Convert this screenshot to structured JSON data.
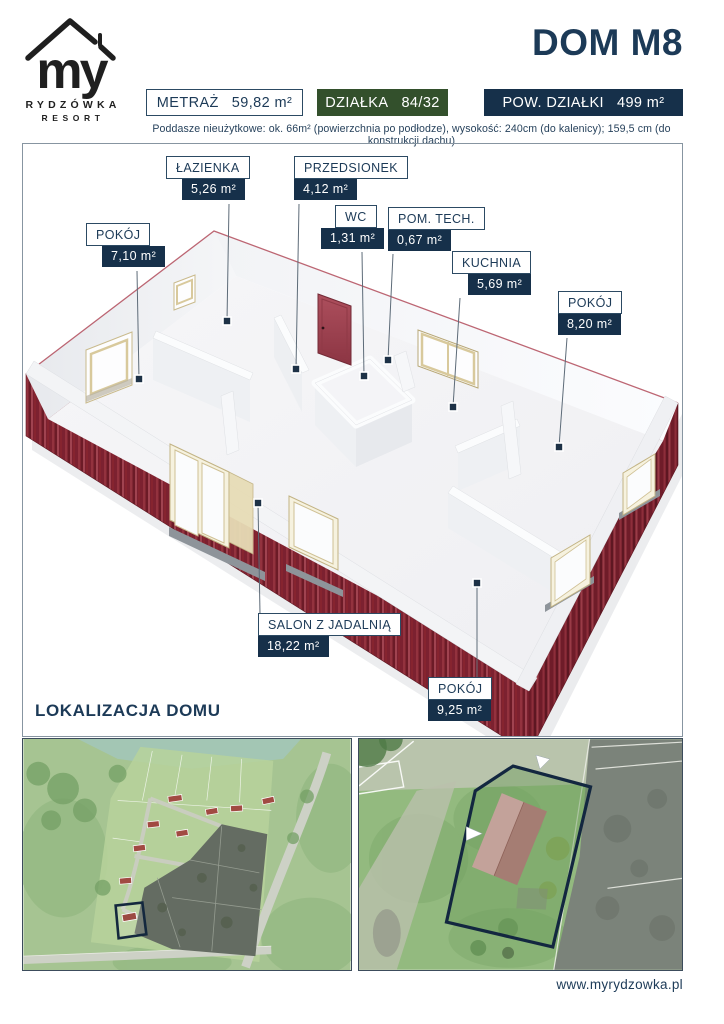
{
  "brand": {
    "logo_text": "my",
    "name_line1": "RYDZÓWKA",
    "name_line2": "RESORT"
  },
  "header": {
    "title": "DOM M8",
    "badges": [
      {
        "label": "METRAŻ",
        "value": "59,82 m²"
      },
      {
        "label": "DZIAŁKA",
        "value": "84/32"
      },
      {
        "label": "POW. DZIAŁKI",
        "value": "499 m²"
      }
    ],
    "subtitle": "Poddasze nieużytkowe: ok. 66m² (powierzchnia po podłodze), wysokość: 240cm (do kalenicy); 159,5 cm (do konstrukcji dachu)"
  },
  "floor_plan": {
    "rooms": [
      {
        "name": "ŁAZIENKA",
        "area": "5,26 m²"
      },
      {
        "name": "PRZEDSIONEK",
        "area": "4,12 m²"
      },
      {
        "name": "WC",
        "area": "1,31 m²"
      },
      {
        "name": "POM. TECH.",
        "area": "0,67 m²"
      },
      {
        "name": "KUCHNIA",
        "area": "5,69 m²"
      },
      {
        "name": "POKÓJ",
        "area": "8,20 m²"
      },
      {
        "name": "POKÓJ",
        "area": "7,10 m²"
      },
      {
        "name": "SALON Z JADALNIĄ",
        "area": "18,22 m²"
      },
      {
        "name": "POKÓJ",
        "area": "9,25 m²"
      }
    ]
  },
  "location": {
    "heading": "LOKALIZACJA DOMU"
  },
  "footer": {
    "website": "www.myrydzowka.pl"
  },
  "colors": {
    "navy": "#16304a",
    "navy_text": "#1c3a57",
    "green_badge": "#33502c",
    "siding_red": "#8e2b38",
    "door_red": "#a34753",
    "frame_tan": "#d9cb9e",
    "plot_outline": "#132740"
  }
}
